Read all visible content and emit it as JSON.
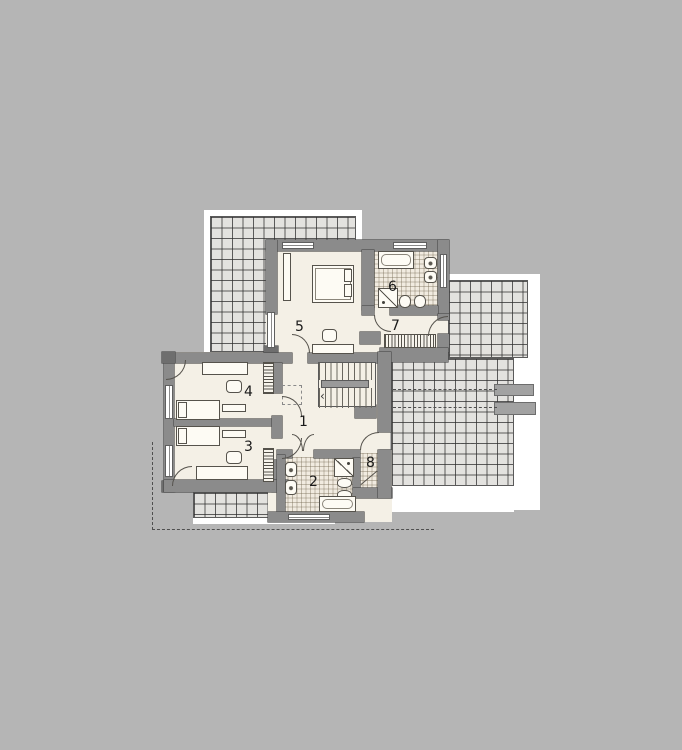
{
  "rooms": [
    {
      "label": "1"
    },
    {
      "label": "2"
    },
    {
      "label": "3"
    },
    {
      "label": "4"
    },
    {
      "label": "5"
    },
    {
      "label": "6"
    },
    {
      "label": "7"
    },
    {
      "label": "8"
    }
  ],
  "stairs": {
    "arrow": "‹"
  },
  "colors": {
    "background": "#b5b5b5",
    "wall": "#8b8b8b",
    "floor": "#f4f0e6",
    "bath_tile": "#f1ebe0",
    "terrace": "#e3e2df",
    "roof_plate": "#ffffff",
    "label_ink": "#1a1a1a"
  }
}
